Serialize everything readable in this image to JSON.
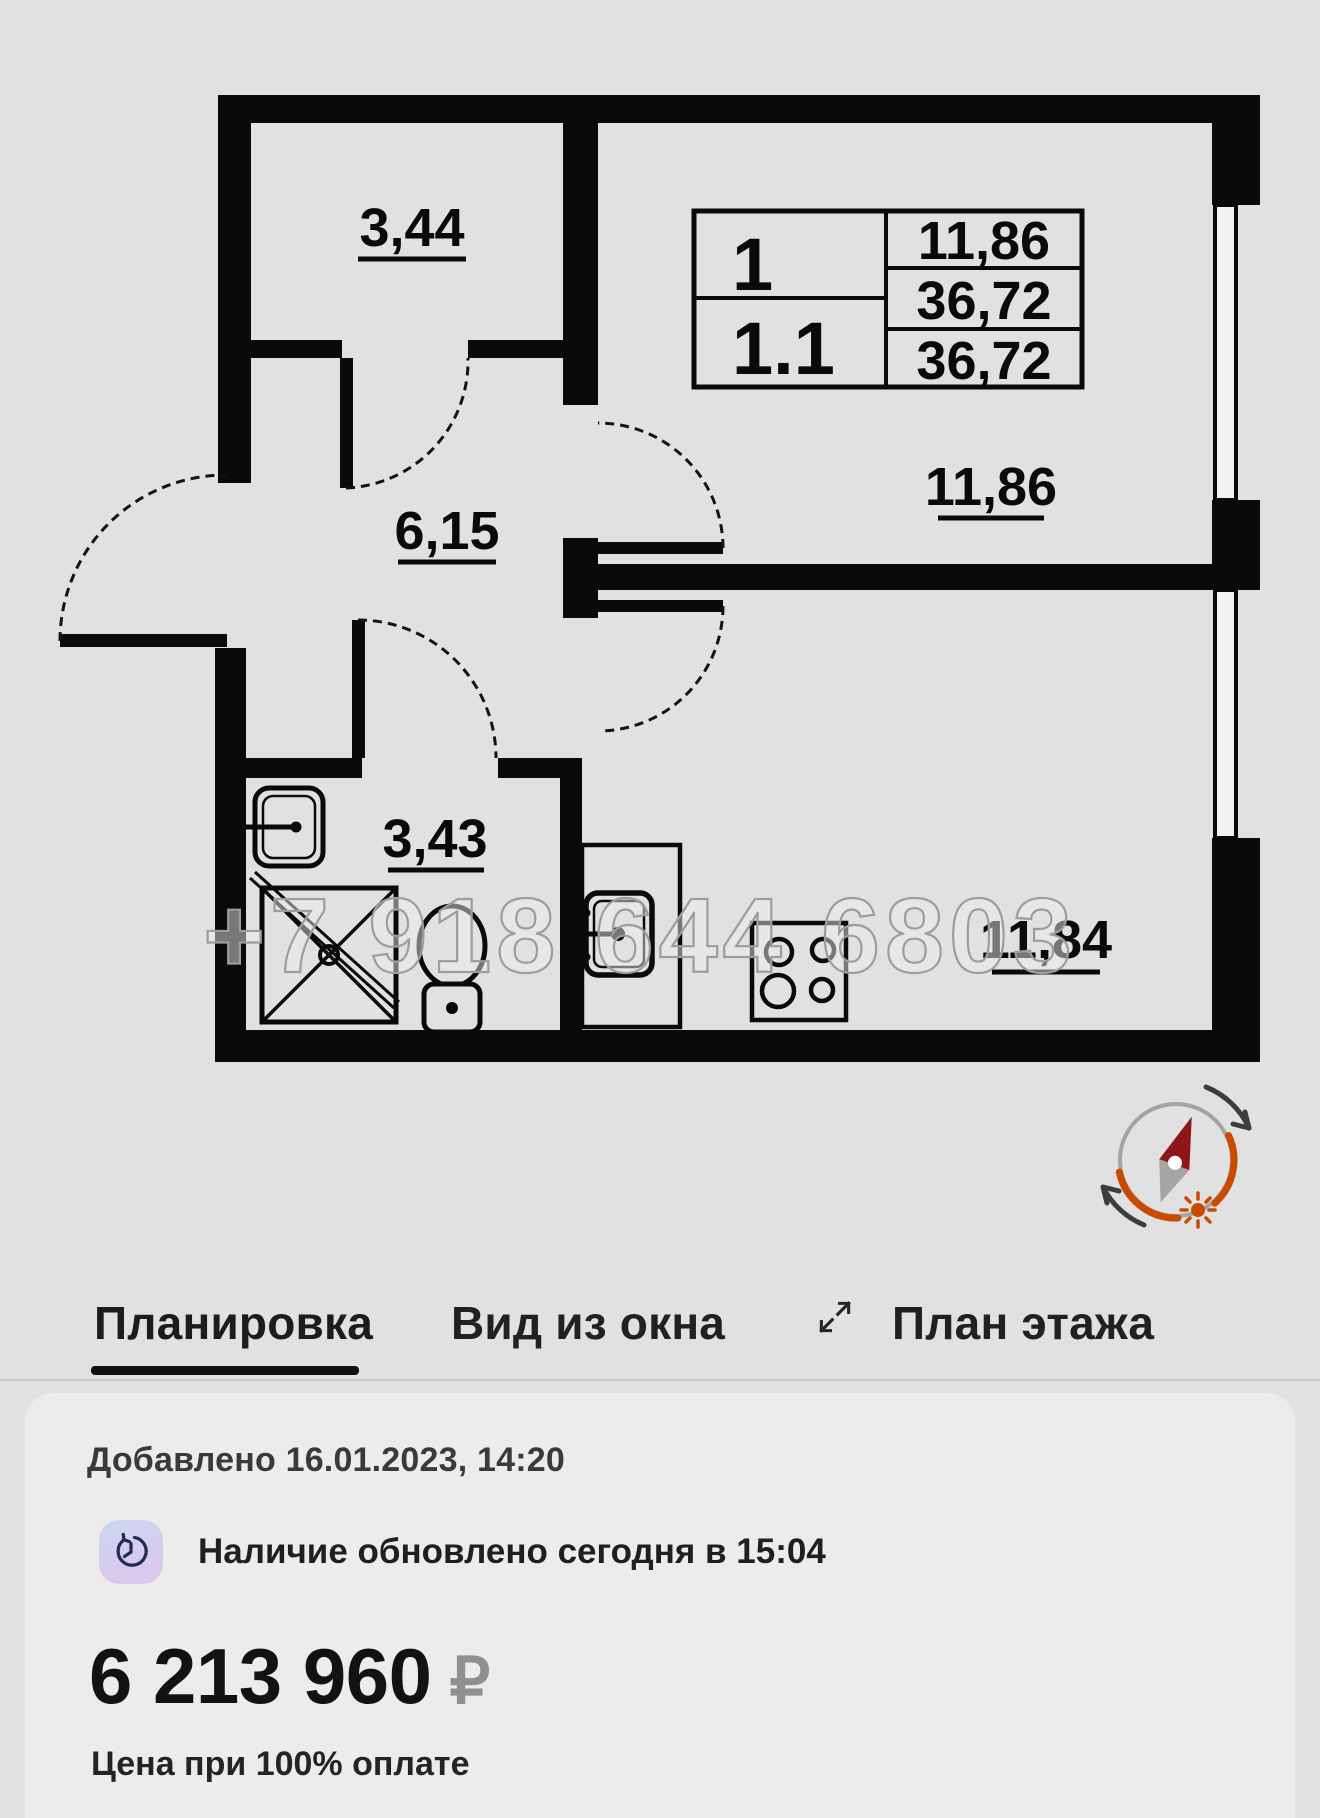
{
  "floor_plan": {
    "room_labels": {
      "storage": "3,44",
      "hall": "6,15",
      "bathroom": "3,43",
      "bedroom": "11,86",
      "kitchen_living": "11,84"
    },
    "info_table": {
      "rooms_count": "1",
      "unit_number": "1.1",
      "living_area": "11,86",
      "total_area": "36,72",
      "declared_area": "36,72"
    },
    "watermark_phone": "+7 918 644 6803"
  },
  "tabs": [
    {
      "label": "Планировка",
      "active": true
    },
    {
      "label": "Вид из окна",
      "active": false
    },
    {
      "label": "План этажа",
      "active": false
    }
  ],
  "card": {
    "added": "Добавлено 16.01.2023, 14:20",
    "availability": "Наличие обновлено сегодня в 15:04",
    "price": "6 213 960",
    "currency": "₽",
    "note": "Цена при 100% оплате"
  },
  "colors": {
    "wall_black": "#0a0a0a",
    "page_bg": "#e1e1e1",
    "card_bg": "#ececec",
    "accent_orange": "#c94b00",
    "needle_red": "#8f1616"
  }
}
